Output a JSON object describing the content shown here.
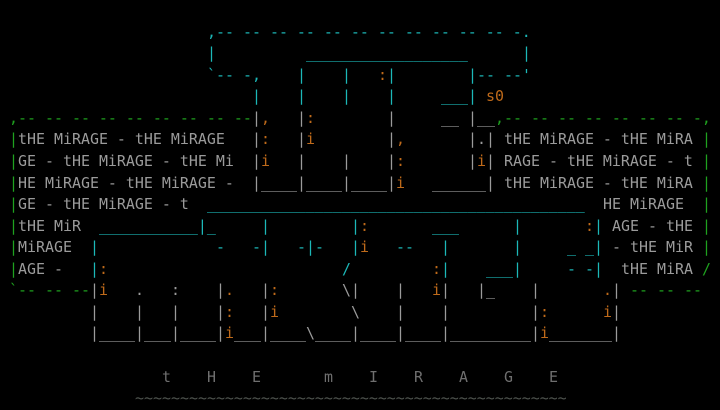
{
  "words": {
    "top_word": "THE",
    "main_word": "MiRAGE",
    "artist_signature": "s0",
    "filler_phrase": "tHE MiRAGE",
    "bottom_caption": "t    H    E        m    I    R    A    G    E"
  },
  "colors": {
    "c": "#1cb8b8",
    "g": "#1fa21f",
    "w": "#9b9b9b",
    "o": "#bf6a1a",
    "d": "#6f6f6f",
    "t": "#4e534e",
    "background": "#000000"
  },
  "art": {
    "lines": [
      [],
      [
        {
          "col": 23,
          "c": "c",
          "t": ",-- -- -- -- -- -- -- -- -- -- -- -."
        }
      ],
      [
        {
          "col": 23,
          "c": "c",
          "t": "|"
        },
        {
          "col": 34,
          "c": "c",
          "t": "__________________"
        },
        {
          "col": 58,
          "c": "c",
          "t": "|"
        }
      ],
      [
        {
          "col": 23,
          "c": "c",
          "t": "`-- -,"
        },
        {
          "col": 33,
          "c": "c",
          "t": "|"
        },
        {
          "col": 38,
          "c": "c",
          "t": "|"
        },
        {
          "col": 42,
          "c": "o",
          "t": ":"
        },
        {
          "col": 43,
          "c": "c",
          "t": "|"
        },
        {
          "col": 52,
          "c": "c",
          "t": "|"
        },
        {
          "col": 53,
          "c": "c",
          "t": "-- --'"
        }
      ],
      [
        {
          "col": 28,
          "c": "c",
          "t": "|"
        },
        {
          "col": 33,
          "c": "c",
          "t": "|"
        },
        {
          "col": 38,
          "c": "c",
          "t": "|"
        },
        {
          "col": 43,
          "c": "c",
          "t": "|"
        },
        {
          "col": 49,
          "c": "c",
          "t": "___|"
        },
        {
          "col": 54,
          "c": "o",
          "t": "s0"
        }
      ],
      [
        {
          "col": 1,
          "c": "g",
          "t": ",-- -- -- -- -- -- -- -- --"
        },
        {
          "col": 28,
          "c": "w",
          "t": "|"
        },
        {
          "col": 29,
          "c": "o",
          "t": ","
        },
        {
          "col": 33,
          "c": "w",
          "t": "|"
        },
        {
          "col": 34,
          "c": "o",
          "t": ":"
        },
        {
          "col": 43,
          "c": "w",
          "t": "|"
        },
        {
          "col": 49,
          "c": "w",
          "t": "__"
        },
        {
          "col": 52,
          "c": "w",
          "t": "|__"
        },
        {
          "col": 55,
          "c": "g",
          "t": ",-- -- -- -- -- -- -- -,"
        }
      ],
      [
        {
          "col": 1,
          "c": "g",
          "t": "|"
        },
        {
          "col": 2,
          "c": "w",
          "t": "tHE MiRAGE - tHE MiRAGE"
        },
        {
          "col": 28,
          "c": "w",
          "t": "|"
        },
        {
          "col": 29,
          "c": "o",
          "t": ":"
        },
        {
          "col": 33,
          "c": "w",
          "t": "|"
        },
        {
          "col": 34,
          "c": "o",
          "t": "i"
        },
        {
          "col": 43,
          "c": "w",
          "t": "|"
        },
        {
          "col": 44,
          "c": "o",
          "t": ","
        },
        {
          "col": 52,
          "c": "w",
          "t": "|"
        },
        {
          "col": 53,
          "c": "w",
          "t": "."
        },
        {
          "col": 54,
          "c": "w",
          "t": "|"
        },
        {
          "col": 56,
          "c": "w",
          "t": "tHE MiRAGE - tHE MiRA"
        },
        {
          "col": 78,
          "c": "g",
          "t": "|"
        }
      ],
      [
        {
          "col": 1,
          "c": "g",
          "t": "|"
        },
        {
          "col": 2,
          "c": "w",
          "t": "GE - tHE MiRAGE - tHE Mi"
        },
        {
          "col": 28,
          "c": "w",
          "t": "|"
        },
        {
          "col": 29,
          "c": "o",
          "t": "i"
        },
        {
          "col": 33,
          "c": "w",
          "t": "|"
        },
        {
          "col": 38,
          "c": "w",
          "t": "|"
        },
        {
          "col": 43,
          "c": "w",
          "t": "|"
        },
        {
          "col": 44,
          "c": "o",
          "t": ":"
        },
        {
          "col": 52,
          "c": "w",
          "t": "|"
        },
        {
          "col": 53,
          "c": "o",
          "t": "i"
        },
        {
          "col": 54,
          "c": "w",
          "t": "|"
        },
        {
          "col": 56,
          "c": "w",
          "t": "RAGE - tHE MiRAGE - t"
        },
        {
          "col": 78,
          "c": "g",
          "t": "|"
        }
      ],
      [
        {
          "col": 1,
          "c": "g",
          "t": "|"
        },
        {
          "col": 2,
          "c": "w",
          "t": "HE MiRAGE - tHE MiRAGE -"
        },
        {
          "col": 28,
          "c": "w",
          "t": "|____"
        },
        {
          "col": 33,
          "c": "w",
          "t": "|____"
        },
        {
          "col": 38,
          "c": "w",
          "t": "|____"
        },
        {
          "col": 43,
          "c": "w",
          "t": "|"
        },
        {
          "col": 44,
          "c": "o",
          "t": "i"
        },
        {
          "col": 48,
          "c": "w",
          "t": "______|"
        },
        {
          "col": 56,
          "c": "w",
          "t": "tHE MiRAGE - tHE MiRA"
        },
        {
          "col": 78,
          "c": "g",
          "t": "|"
        }
      ],
      [
        {
          "col": 1,
          "c": "g",
          "t": "|"
        },
        {
          "col": 2,
          "c": "w",
          "t": "GE - tHE MiRAGE - t"
        },
        {
          "col": 23,
          "c": "c",
          "t": "__________________________________________"
        },
        {
          "col": 67,
          "c": "w",
          "t": "HE MiRAGE"
        },
        {
          "col": 78,
          "c": "g",
          "t": "|"
        }
      ],
      [
        {
          "col": 1,
          "c": "g",
          "t": "|"
        },
        {
          "col": 2,
          "c": "w",
          "t": "tHE MiR"
        },
        {
          "col": 11,
          "c": "c",
          "t": "___________|_"
        },
        {
          "col": 29,
          "c": "c",
          "t": "|"
        },
        {
          "col": 39,
          "c": "c",
          "t": "|"
        },
        {
          "col": 40,
          "c": "o",
          "t": ":"
        },
        {
          "col": 48,
          "c": "c",
          "t": "___"
        },
        {
          "col": 57,
          "c": "c",
          "t": "|"
        },
        {
          "col": 65,
          "c": "o",
          "t": ":"
        },
        {
          "col": 66,
          "c": "c",
          "t": "|"
        },
        {
          "col": 68,
          "c": "w",
          "t": "AGE - tHE"
        },
        {
          "col": 78,
          "c": "g",
          "t": "|"
        }
      ],
      [
        {
          "col": 1,
          "c": "g",
          "t": "|"
        },
        {
          "col": 2,
          "c": "w",
          "t": "MiRAGE"
        },
        {
          "col": 10,
          "c": "c",
          "t": "|"
        },
        {
          "col": 24,
          "c": "c",
          "t": "-"
        },
        {
          "col": 28,
          "c": "c",
          "t": "-|"
        },
        {
          "col": 33,
          "c": "c",
          "t": "-|-"
        },
        {
          "col": 39,
          "c": "c",
          "t": "|"
        },
        {
          "col": 40,
          "c": "o",
          "t": "i"
        },
        {
          "col": 44,
          "c": "c",
          "t": "--"
        },
        {
          "col": 49,
          "c": "c",
          "t": "|"
        },
        {
          "col": 57,
          "c": "c",
          "t": "|"
        },
        {
          "col": 63,
          "c": "c",
          "t": "_ _"
        },
        {
          "col": 66,
          "c": "c",
          "t": "|"
        },
        {
          "col": 68,
          "c": "w",
          "t": "- tHE MiR"
        },
        {
          "col": 78,
          "c": "g",
          "t": "|"
        }
      ],
      [
        {
          "col": 1,
          "c": "g",
          "t": "|"
        },
        {
          "col": 2,
          "c": "w",
          "t": "AGE -"
        },
        {
          "col": 10,
          "c": "c",
          "t": "|"
        },
        {
          "col": 11,
          "c": "o",
          "t": ":"
        },
        {
          "col": 38,
          "c": "c",
          "t": "/"
        },
        {
          "col": 48,
          "c": "o",
          "t": ":"
        },
        {
          "col": 49,
          "c": "c",
          "t": "|"
        },
        {
          "col": 54,
          "c": "c",
          "t": "___|"
        },
        {
          "col": 63,
          "c": "c",
          "t": "- -"
        },
        {
          "col": 66,
          "c": "c",
          "t": "|"
        },
        {
          "col": 69,
          "c": "w",
          "t": "tHE MiRA"
        },
        {
          "col": 78,
          "c": "g",
          "t": "/"
        }
      ],
      [
        {
          "col": 1,
          "c": "g",
          "t": "`-- -- --"
        },
        {
          "col": 10,
          "c": "w",
          "t": "|"
        },
        {
          "col": 11,
          "c": "o",
          "t": "i"
        },
        {
          "col": 15,
          "c": "w",
          "t": "."
        },
        {
          "col": 19,
          "c": "w",
          "t": ":"
        },
        {
          "col": 24,
          "c": "w",
          "t": "|"
        },
        {
          "col": 25,
          "c": "o",
          "t": "."
        },
        {
          "col": 29,
          "c": "w",
          "t": "|"
        },
        {
          "col": 30,
          "c": "o",
          "t": ":"
        },
        {
          "col": 38,
          "c": "w",
          "t": "\\|"
        },
        {
          "col": 44,
          "c": "w",
          "t": "|"
        },
        {
          "col": 48,
          "c": "o",
          "t": "i"
        },
        {
          "col": 49,
          "c": "w",
          "t": "|"
        },
        {
          "col": 53,
          "c": "w",
          "t": "|_"
        },
        {
          "col": 59,
          "c": "w",
          "t": "|"
        },
        {
          "col": 67,
          "c": "o",
          "t": "."
        },
        {
          "col": 68,
          "c": "w",
          "t": "|"
        },
        {
          "col": 70,
          "c": "g",
          "t": "-- -- --"
        }
      ],
      [
        {
          "col": 10,
          "c": "w",
          "t": "|"
        },
        {
          "col": 15,
          "c": "w",
          "t": "|"
        },
        {
          "col": 19,
          "c": "w",
          "t": "|"
        },
        {
          "col": 24,
          "c": "w",
          "t": "|"
        },
        {
          "col": 25,
          "c": "o",
          "t": ":"
        },
        {
          "col": 29,
          "c": "w",
          "t": "|"
        },
        {
          "col": 30,
          "c": "o",
          "t": "i"
        },
        {
          "col": 39,
          "c": "w",
          "t": "\\"
        },
        {
          "col": 44,
          "c": "w",
          "t": "|"
        },
        {
          "col": 49,
          "c": "w",
          "t": "|"
        },
        {
          "col": 59,
          "c": "w",
          "t": "|"
        },
        {
          "col": 60,
          "c": "o",
          "t": ":"
        },
        {
          "col": 67,
          "c": "o",
          "t": "i"
        },
        {
          "col": 68,
          "c": "w",
          "t": "|"
        }
      ],
      [
        {
          "col": 10,
          "c": "w",
          "t": "|____"
        },
        {
          "col": 15,
          "c": "w",
          "t": "|___"
        },
        {
          "col": 19,
          "c": "w",
          "t": "|____"
        },
        {
          "col": 24,
          "c": "w",
          "t": "|"
        },
        {
          "col": 25,
          "c": "o",
          "t": "i"
        },
        {
          "col": 26,
          "c": "w",
          "t": "___"
        },
        {
          "col": 29,
          "c": "w",
          "t": "|____"
        },
        {
          "col": 34,
          "c": "w",
          "t": "\\____"
        },
        {
          "col": 39,
          "c": "w",
          "t": "|____"
        },
        {
          "col": 44,
          "c": "w",
          "t": "|____"
        },
        {
          "col": 49,
          "c": "w",
          "t": "|_________"
        },
        {
          "col": 59,
          "c": "w",
          "t": "|"
        },
        {
          "col": 60,
          "c": "o",
          "t": "i"
        },
        {
          "col": 61,
          "c": "w",
          "t": "_______|"
        }
      ],
      [],
      [
        {
          "col": 18,
          "c": "d",
          "t": "t"
        },
        {
          "col": 23,
          "c": "d",
          "t": "H"
        },
        {
          "col": 28,
          "c": "d",
          "t": "E"
        },
        {
          "col": 36,
          "c": "d",
          "t": "m"
        },
        {
          "col": 41,
          "c": "d",
          "t": "I"
        },
        {
          "col": 46,
          "c": "d",
          "t": "R"
        },
        {
          "col": 51,
          "c": "d",
          "t": "A"
        },
        {
          "col": 56,
          "c": "d",
          "t": "G"
        },
        {
          "col": 61,
          "c": "d",
          "t": "E"
        }
      ],
      [
        {
          "col": 15,
          "c": "t",
          "t": "~~~~~~~~~~~~~~~~~~~~~~~~~~~~~~~~~~~~~~~~~~~~~~~~"
        }
      ]
    ]
  }
}
